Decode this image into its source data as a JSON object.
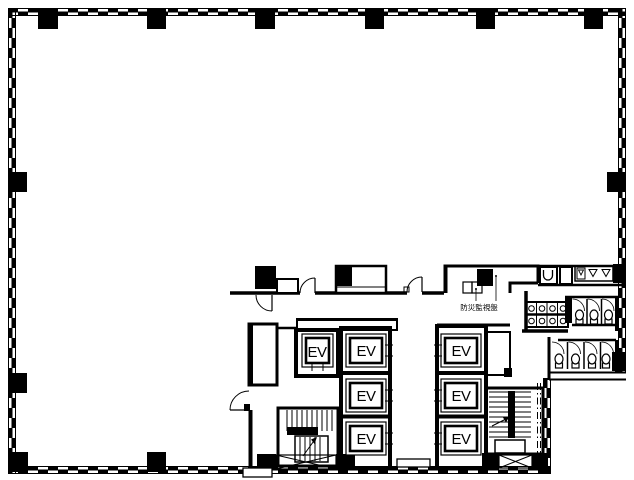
{
  "drawing": {
    "kind": "architectural-floor-plan",
    "ink_color": "#000000",
    "paper_color": "#ffffff"
  },
  "labels": {
    "disaster_panel": "防災監視盤"
  },
  "elevators": [
    {
      "label": "EV"
    },
    {
      "label": "EV"
    },
    {
      "label": "EV"
    },
    {
      "label": "EV"
    },
    {
      "label": "EV"
    },
    {
      "label": "EV"
    },
    {
      "label": "EV"
    }
  ]
}
